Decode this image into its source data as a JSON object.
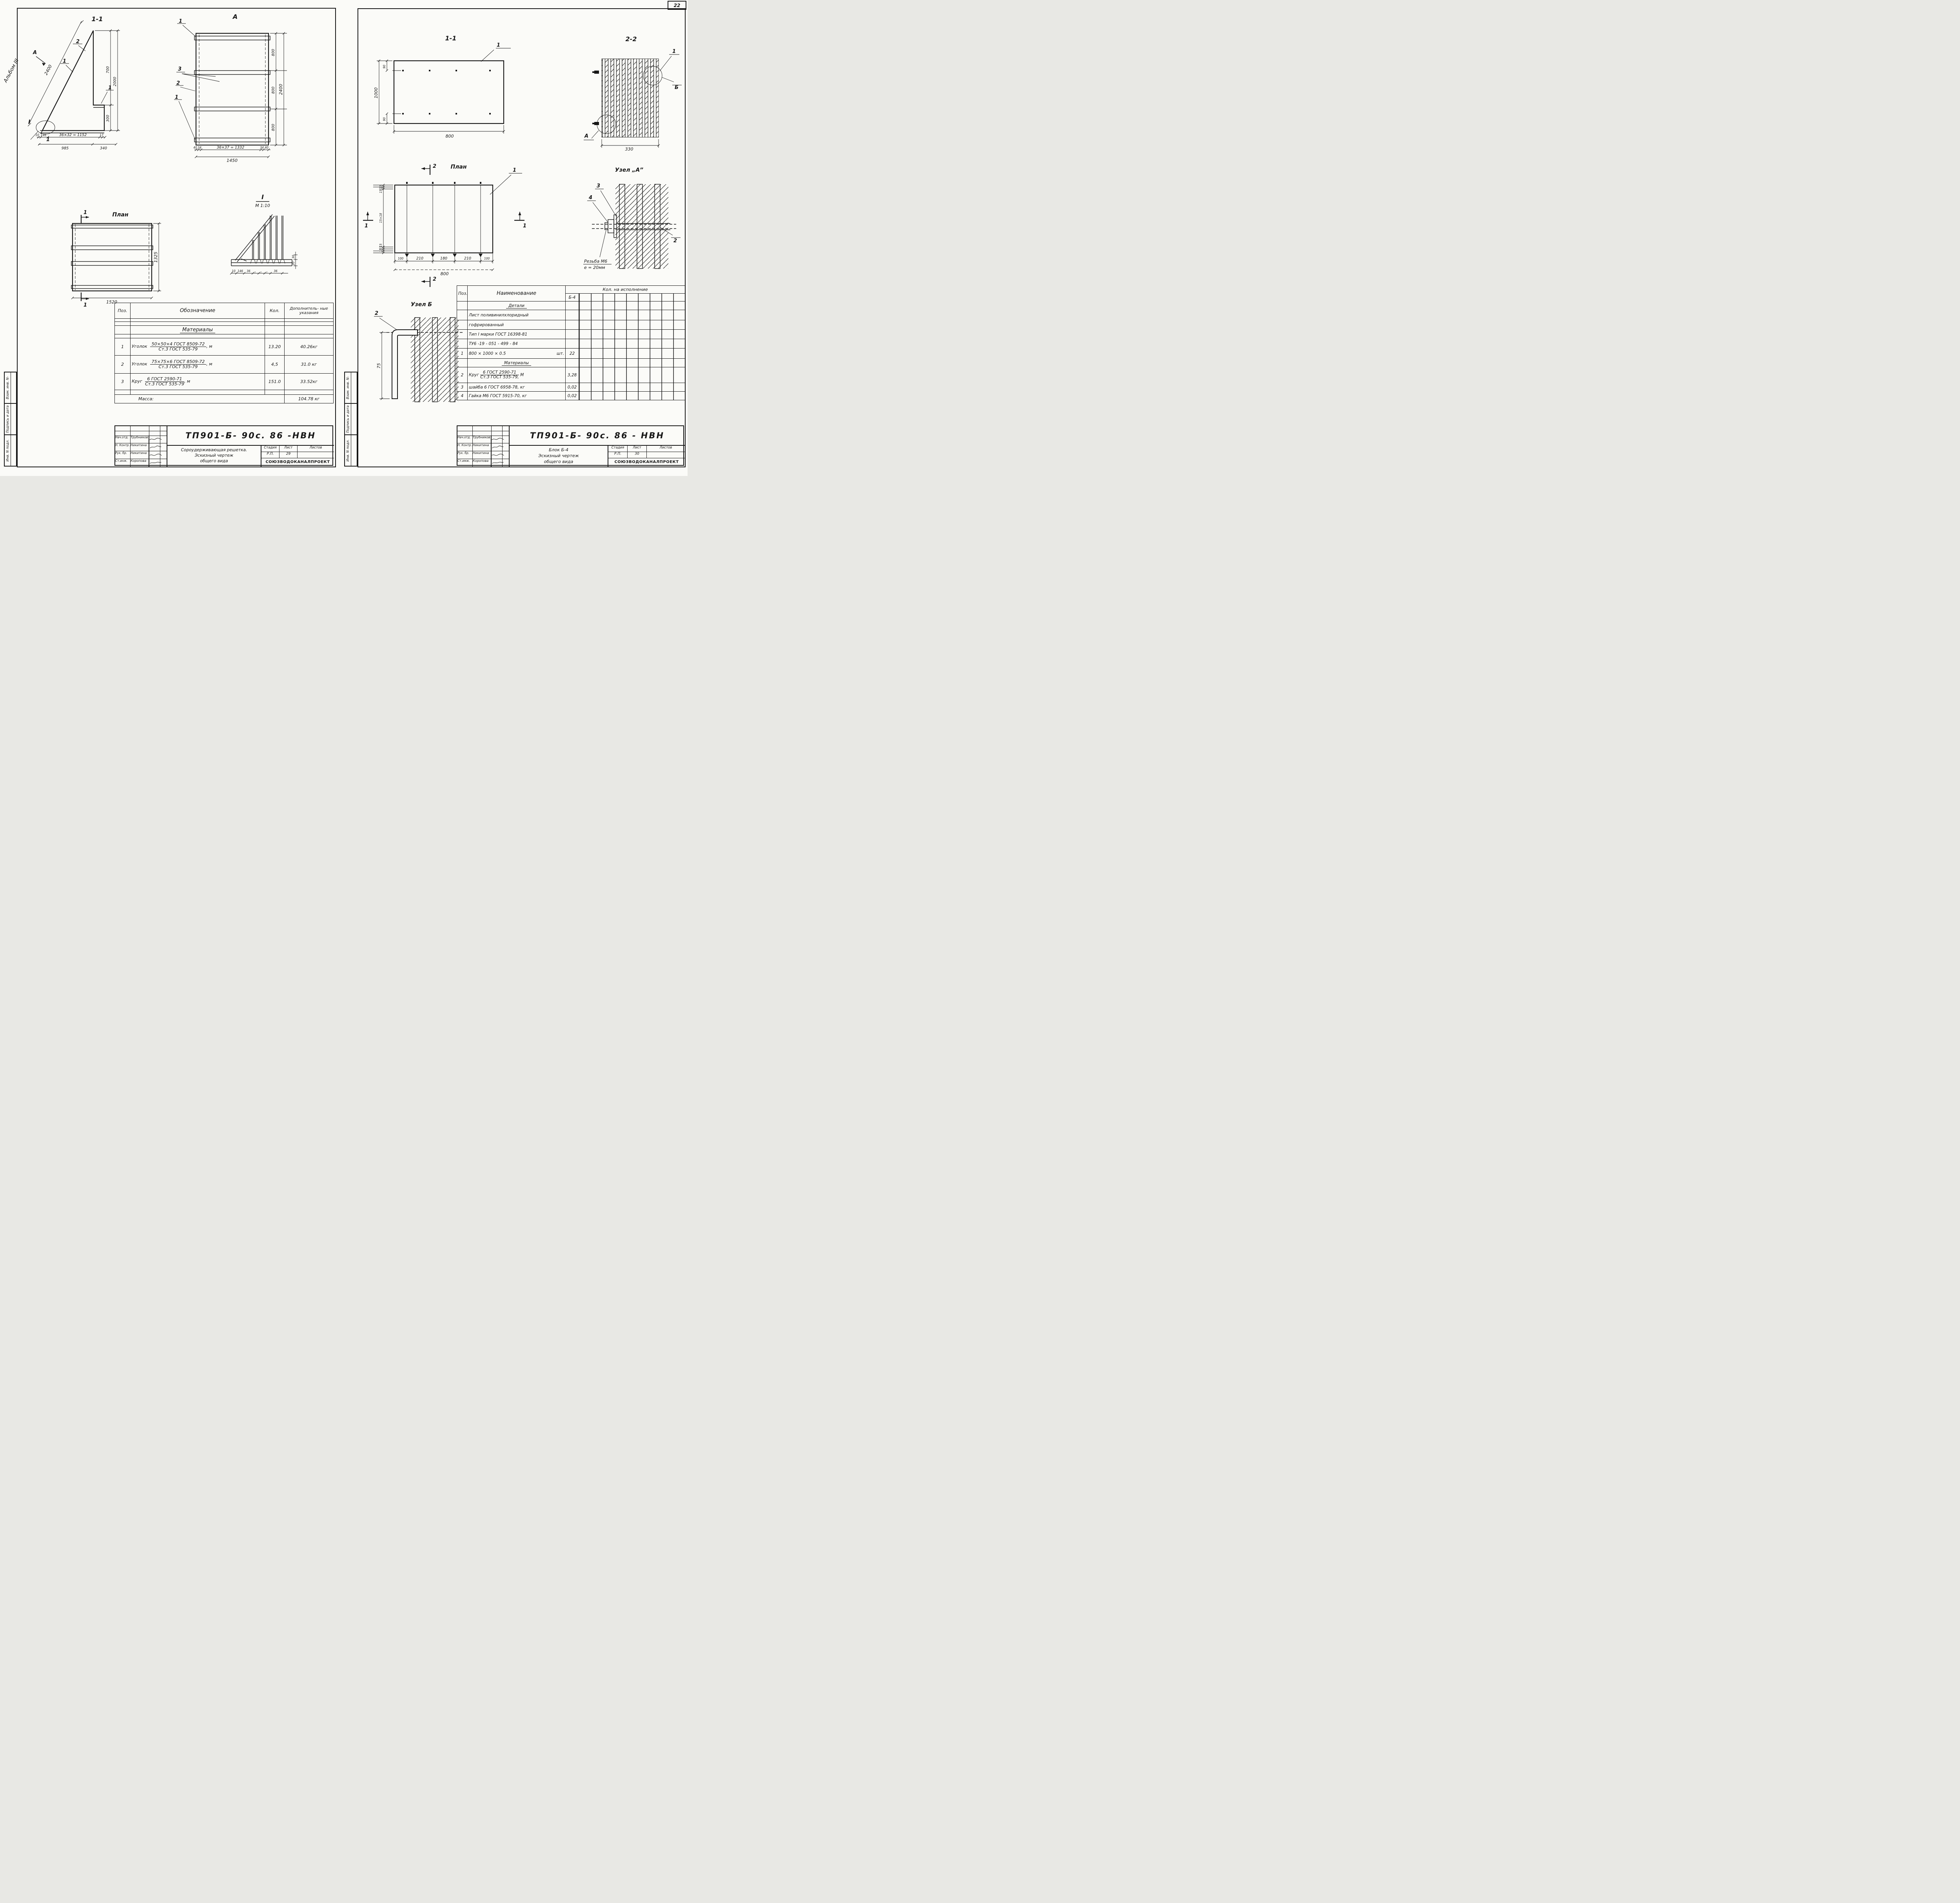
{
  "page": {
    "number": "22"
  },
  "margins": {
    "album": "Альбом III",
    "box1": "Взам. инв. N-",
    "box2": "Подпись и дата",
    "box3": "Инв. N подл."
  },
  "sheet1": {
    "fig_section": {
      "title": "1-1",
      "view_arrow": "А",
      "callout_2": "2",
      "callout_1a": "1",
      "callout_1b": "1",
      "detail_mark": "I",
      "callout_1c": "1",
      "dim_hyp": "2400",
      "dim_700": "700",
      "dim_2000": "2000",
      "dim_300": "300",
      "dims_bottom1": [
        "10",
        "146",
        "36×32 = 1152",
        "17"
      ],
      "dims_bottom2": [
        "985",
        "340"
      ]
    },
    "fig_a": {
      "title": "А",
      "co_1t": "1",
      "co_3": "3",
      "co_2": "2",
      "co_1b": "1",
      "dims_right": [
        "800",
        "800",
        "800"
      ],
      "dim_total_v": "2400",
      "dims_bottom": [
        "40",
        "34",
        "36×37 = 1332",
        "34",
        "40"
      ],
      "dim_total": "1450"
    },
    "fig_plan": {
      "title": "План",
      "mark_top": "1",
      "mark_bottom": "1",
      "dim_right": "1325",
      "dim_bottom": "1520"
    },
    "fig_detail": {
      "title": "I",
      "scale": "М 1:10",
      "dims_bottom": [
        "10",
        "146",
        "36",
        "„",
        "„",
        "„",
        "36"
      ],
      "dim_30": "30",
      "dim_20": "20"
    },
    "table": {
      "h_pos": "Поз.",
      "h_name": "Обозначение",
      "h_qty": "Кол.",
      "h_note": "Дополнитель- ные указания",
      "section": "Материалы",
      "rows": [
        {
          "pos": "1",
          "name": "Уголок",
          "top": "50×50×4  ГОСТ 8509-72",
          "bot": "Ст.3  ГОСТ 535-79",
          "unit": ", м",
          "qty": "13.20",
          "note": "40.26кг"
        },
        {
          "pos": "2",
          "name": "Уголок",
          "top": "75×75×6  ГОСТ 8509-72",
          "bot": "Ст.3  ГОСТ 535-79",
          "unit": ", м",
          "qty": "4,5",
          "note": "31.0 кг"
        },
        {
          "pos": "3",
          "name": "Круг",
          "top": "6  ГОСТ  2590-71",
          "bot": "Ст.3  ГОСТ 535-79",
          "unit": ", м",
          "qty": "151.0",
          "note": "33.52кг"
        }
      ],
      "footer_label": "Масса:",
      "footer_value": "104.78 кг"
    },
    "titleblock": {
      "doc": "ТП901-Б- 90с. 86  -НВН",
      "roles": [
        {
          "role": "Нач.отд.",
          "name": "Трубников"
        },
        {
          "role": "Н. Контр.",
          "name": "Никитина"
        },
        {
          "role": "Рук. бр.",
          "name": "Никитина"
        },
        {
          "role": "Ст.инж.",
          "name": "Коропова"
        },
        {
          "role": "Инженер",
          "name": "Белова"
        },
        {
          "role": "Техник",
          "name": "Соловьева"
        }
      ],
      "title1": "Сороудерживающая решетка.",
      "title2": "Эскизный чертеж",
      "title3": "общего вида",
      "h_stage": "Стадия",
      "h_sheet": "Лист",
      "h_sheets": "Листов",
      "stage": "Р.П.",
      "sheet": "29",
      "sheets": "",
      "org": "СОЮЗВОДОКАНАЛПРОЕКТ"
    }
  },
  "sheet2": {
    "fig_11": {
      "title": "1-1",
      "callout": "1",
      "dim_1000": "1000",
      "dim_90t": "90",
      "dim_90b": "90",
      "dim_800": "800"
    },
    "fig_22": {
      "title": "2-2",
      "callout_1": "1",
      "callout_b": "Б",
      "callout_a": "А",
      "dim_330": "330"
    },
    "fig_plan": {
      "title": "План",
      "mark_2t": "2",
      "mark_2b": "2",
      "mark_1l": "1",
      "mark_1r": "1",
      "callout": "1",
      "dims_left": [
        "15",
        "15",
        "15×18",
        "15",
        "15"
      ],
      "dims_bottom": [
        "100",
        "210",
        "180",
        "210",
        "100"
      ],
      "dim_total": "800"
    },
    "uzel_a": {
      "title": "Узел „А”",
      "callout_3": "3",
      "callout_4": "4",
      "callout_2": "2",
      "note1": "Резьба М6",
      "note2": "е = 20мм"
    },
    "uzel_b": {
      "title": "Узел Б",
      "callout_2": "2",
      "dim_75": "75"
    },
    "table": {
      "h_pos": "Поз.",
      "h_name": "Наименование",
      "h_qty": "Кол.  на   исполнение",
      "h_sub": "Б-4",
      "section1": "Детали",
      "text1": "Лист поливинилхлоридный",
      "text2": "гофрированный",
      "text3": "Тип I марки ГОСТ 16398-81",
      "text4": "ТУ6 -19 - 051 - 499 - 84",
      "row1": {
        "pos": "1",
        "name": "800 × 1000 × 0.5",
        "unit": "шт.",
        "qty": "22"
      },
      "section2": "Материалы",
      "row2": {
        "pos": "2",
        "name": "Круг",
        "top": "6 ГОСТ 2590-71",
        "bot": "Ст.3 ГОСТ 535-79,",
        "unit": "М",
        "qty": "3,28"
      },
      "row3": {
        "pos": "3",
        "name": "шайба 6 ГОСТ 6958-78,  кг",
        "qty": "0,02"
      },
      "row4": {
        "pos": "4",
        "name": "Гайка М6 ГОСТ 5915-70, кг",
        "qty": "0,02"
      }
    },
    "titleblock": {
      "doc": "ТП901-Б- 90с. 86 - НВН",
      "roles": [
        {
          "role": "Нач.отд.",
          "name": "Трубников"
        },
        {
          "role": "Н. Контр.",
          "name": "Никитина"
        },
        {
          "role": "Рук. бр.",
          "name": "Никитина"
        },
        {
          "role": "Ст.имж.",
          "name": "Коропова"
        },
        {
          "role": "Инженер",
          "name": "Троценко"
        },
        {
          "role": "Техник",
          "name": "Соловьева"
        }
      ],
      "title1": "Блок Б-4",
      "title2": "Эскизный чертеж",
      "title3": "общего вида",
      "h_stage": "Стадия",
      "h_sheet": "Лист",
      "h_sheets": "Листов",
      "stage": "Р.П.",
      "sheet": "30",
      "sheets": "",
      "org": "СОЮЗВОДОКАНАЛПРОЕКТ"
    }
  }
}
